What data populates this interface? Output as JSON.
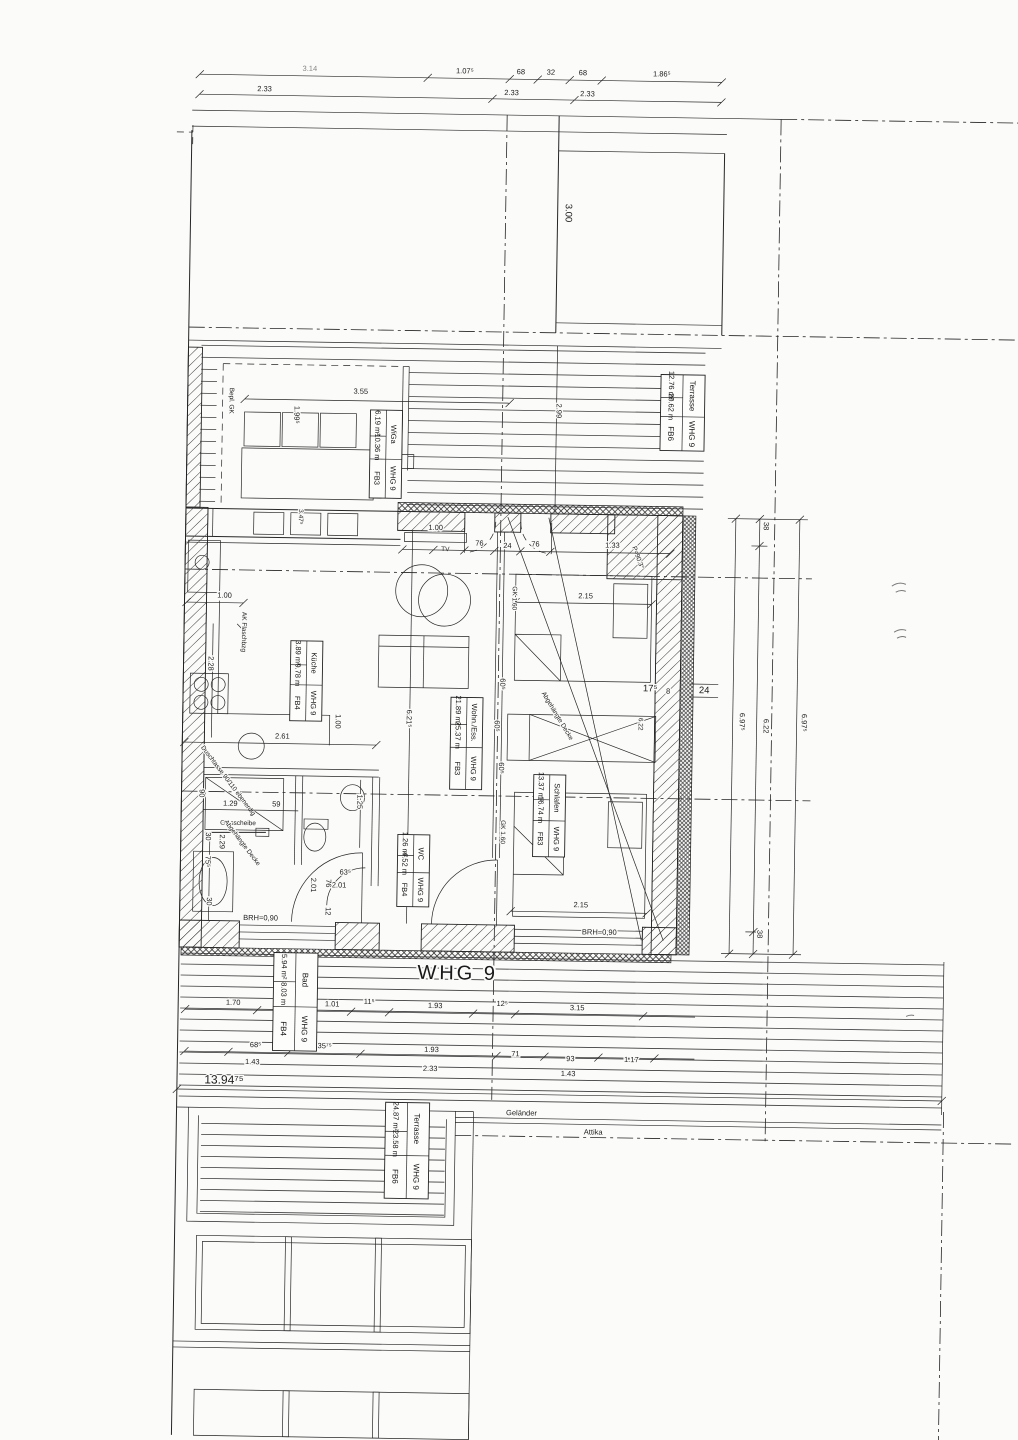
{
  "page": {
    "width": 1018,
    "height": 1440,
    "paper": "#fbfbfa",
    "ink": "#262626"
  },
  "title": "WHG 9",
  "rooms": {
    "wiga": {
      "name": "WiGa",
      "area": "6.19 m²",
      "extra": "10.36 m",
      "unit": "WHG 9",
      "floor": "FB3"
    },
    "terrasse_top": {
      "name": "Terrasse",
      "area": "12.76 m²",
      "extra": "20.62 m",
      "unit": "WHG 9",
      "floor": "FB6"
    },
    "kueche": {
      "name": "Küche",
      "area": "3.89 m²",
      "extra": "9.78 m",
      "unit": "WHG 9",
      "floor": "FB4"
    },
    "wohnen": {
      "name": "Wohn./Ess.",
      "area": "21.89 m²",
      "extra": "25.37 m",
      "unit": "WHG 9",
      "floor": "FB3"
    },
    "schlafen": {
      "name": "Schlafen",
      "area": "13.37 m²",
      "extra": "16.74 m",
      "unit": "WHG 9",
      "floor": "FB3"
    },
    "wc": {
      "name": "WC",
      "area": "1.26 m²",
      "extra": "4.52 m",
      "unit": "WHG 9",
      "floor": "FB4"
    },
    "bad": {
      "name": "Bad",
      "area": "5.94 m²",
      "extra": "8.03 m",
      "unit": "WHG 9",
      "floor": "FB4"
    },
    "terrasse_bottom": {
      "name": "Terrasse",
      "area": "24.87 m²",
      "extra": "23.58 m",
      "unit": "WHG 9",
      "floor": "FB6"
    }
  },
  "annotations": {
    "bepl_gk": "Bepl. GK",
    "tv": "TV",
    "ak": "AK Flaschbzg",
    "glasscheibe": "Glasscheibe",
    "duschtasse": "Duschtasse 90/110 ebenerdig",
    "decke_bad": "Abgehängte Decke",
    "decke_schlafen": "Abgehängte Decke",
    "gk_a": "GK 1.60",
    "gk_b": "GK 1.60",
    "roof_angle": "P=90.3°",
    "brh_a": "BRH=0,90",
    "brh_b": "BRH=0,90",
    "gelaender": "Geländer",
    "attika": "Attika"
  },
  "dims": {
    "t1": "3.14",
    "t2": "1.07⁵",
    "t3": "68",
    "t4": "32",
    "t5": "68",
    "t6": "1.86⁵",
    "t7": "2.33",
    "t8": "2.33",
    "t9": "2.33",
    "v300": "3.00",
    "v299": "2.99",
    "wiga_355": "3.55",
    "wiga_199": "1.99⁵",
    "win_347": "3.47⁵",
    "tv_100": "1.00",
    "door_76a": "76",
    "door_24": "24",
    "door_76b": "76",
    "d_133": "1.33",
    "bed_215a": "2.15",
    "bed_215b": "2.15",
    "k_100a": "1.00",
    "k_228": "2.28",
    "k_261": "2.61",
    "k_100b": "1.00",
    "lv_621": "6.21⁵",
    "gk60_a": "60⁵",
    "gk60_b": "60⁵",
    "gk60_c": "60⁵",
    "wr_622": "6.22",
    "w_175": "17⁵",
    "w_8": "8",
    "w_24": "24",
    "r_38a": "38",
    "r_622": "6.22",
    "r_38b": "38",
    "r_697a": "6.97⁵",
    "r_697b": "6.97⁵",
    "b_90": "90",
    "b_129": "1.29",
    "b_59": "59",
    "b_30a": "30",
    "b_229": "2.29",
    "b_755": "75⁵",
    "b_30b": "30",
    "b_125": "1.25",
    "b_635": "63⁵",
    "b_201a": "2.01",
    "b_201b": "2.01",
    "b_76": "76",
    "b_12": "12",
    "r1_1": "1.70",
    "r1_2": "1.01",
    "r1_3": "11⁵",
    "r1_4": "1.93",
    "r1_5": "12⁵",
    "r1_6": "3.15",
    "r2_1": "68⁵",
    "r2_2": "1.35⁷⁵",
    "r2_3": "1.93",
    "r2_4": "71",
    "r2_5": "93",
    "r2_6": "1.17",
    "r3_1": "1.43",
    "r3_2": "2.33",
    "r3_3": "1.43",
    "total": "13.94⁷⁵"
  }
}
